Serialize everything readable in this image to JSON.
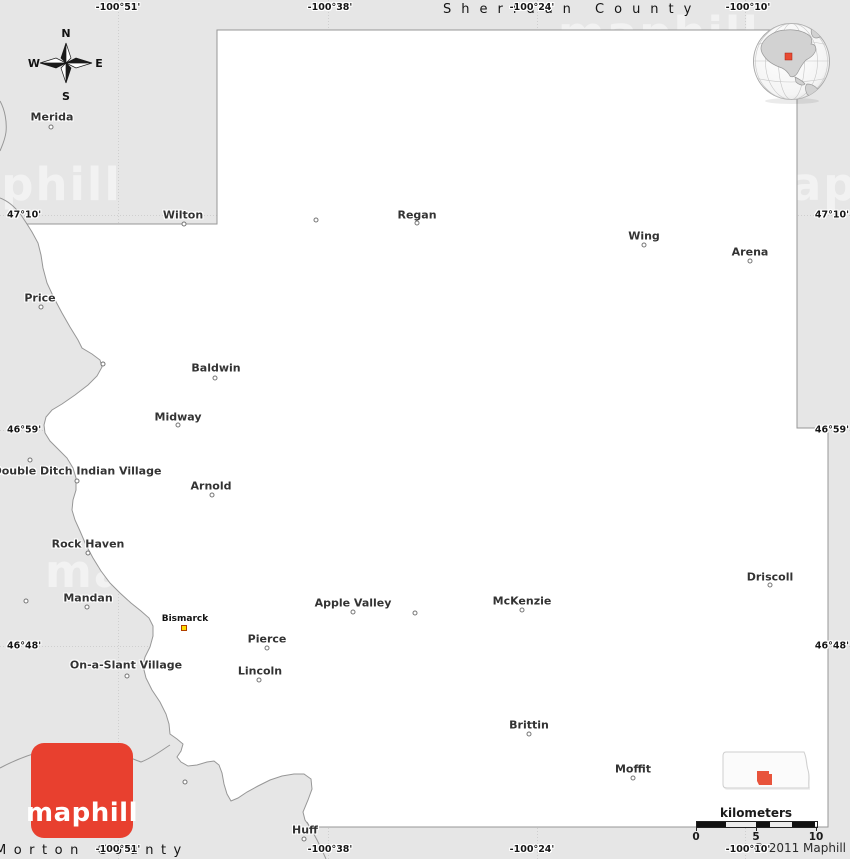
{
  "map": {
    "region_labels": [
      {
        "text": "Sheridan County",
        "position": "top"
      },
      {
        "text": "Morton County",
        "position": "bottom"
      }
    ],
    "towns": [
      {
        "name": "Merida",
        "label": [
          52,
          117
        ],
        "marker": [
          51,
          127
        ],
        "type": "circle"
      },
      {
        "name": "Wilton",
        "label": [
          183,
          215
        ],
        "marker": [
          184,
          224
        ],
        "type": "circle"
      },
      {
        "name": "Regan",
        "label": [
          417,
          215
        ],
        "marker": [
          417,
          223
        ],
        "type": "circle"
      },
      {
        "name": "Wing",
        "label": [
          644,
          236
        ],
        "marker": [
          644,
          245
        ],
        "type": "circle"
      },
      {
        "name": "Arena",
        "label": [
          750,
          252
        ],
        "marker": [
          750,
          261
        ],
        "type": "circle"
      },
      {
        "name": "Price",
        "label": [
          40,
          298
        ],
        "marker": [
          41,
          307
        ],
        "type": "circle"
      },
      {
        "name": "Baldwin",
        "label": [
          216,
          368
        ],
        "marker": [
          215,
          378
        ],
        "type": "circle"
      },
      {
        "name": "Midway",
        "label": [
          178,
          417
        ],
        "marker": [
          178,
          425
        ],
        "type": "circle"
      },
      {
        "name": "Double Ditch Indian Village",
        "label": [
          77,
          471
        ],
        "marker": [
          77,
          481
        ],
        "type": "circle"
      },
      {
        "name": "Arnold",
        "label": [
          211,
          486
        ],
        "marker": [
          212,
          495
        ],
        "type": "circle"
      },
      {
        "name": "Rock Haven",
        "label": [
          88,
          544
        ],
        "marker": [
          88,
          553
        ],
        "type": "circle"
      },
      {
        "name": "Mandan",
        "label": [
          88,
          598
        ],
        "marker": [
          87,
          607
        ],
        "type": "circle"
      },
      {
        "name": "Bismarck",
        "label": [
          185,
          619
        ],
        "marker": [
          184,
          628
        ],
        "type": "square",
        "small": true
      },
      {
        "name": "Apple Valley",
        "label": [
          353,
          603
        ],
        "marker": [
          353,
          612
        ],
        "type": "circle"
      },
      {
        "name": "McKenzie",
        "label": [
          522,
          601
        ],
        "marker": [
          522,
          610
        ],
        "type": "circle"
      },
      {
        "name": "Driscoll",
        "label": [
          770,
          577
        ],
        "marker": [
          770,
          585
        ],
        "type": "circle"
      },
      {
        "name": "Pierce",
        "label": [
          267,
          639
        ],
        "marker": [
          267,
          648
        ],
        "type": "circle"
      },
      {
        "name": "Lincoln",
        "label": [
          260,
          671
        ],
        "marker": [
          259,
          680
        ],
        "type": "circle"
      },
      {
        "name": "On-a-Slant Village",
        "label": [
          126,
          665
        ],
        "marker": [
          127,
          676
        ],
        "type": "circle"
      },
      {
        "name": "Brittin",
        "label": [
          529,
          725
        ],
        "marker": [
          529,
          734
        ],
        "type": "circle"
      },
      {
        "name": "Moffit",
        "label": [
          633,
          769
        ],
        "marker": [
          633,
          778
        ],
        "type": "circle"
      },
      {
        "name": "Huff",
        "label": [
          305,
          830
        ],
        "marker": [
          304,
          839
        ],
        "type": "circle"
      }
    ],
    "unnamed_markers": [
      [
        316,
        220
      ],
      [
        103,
        364
      ],
      [
        30,
        460
      ],
      [
        26,
        601
      ],
      [
        415,
        613
      ],
      [
        185,
        782
      ]
    ],
    "longitude_labels": {
      "values": [
        "-100°51'",
        "-100°38'",
        "-100°24'",
        "-100°10'"
      ],
      "x": [
        118,
        330,
        532,
        748
      ]
    },
    "latitude_labels": {
      "values": [
        "47°10'",
        "46°59'",
        "46°48'"
      ],
      "y": [
        215,
        430,
        646
      ]
    }
  },
  "compass": {
    "n": "N",
    "s": "S",
    "e": "E",
    "w": "W"
  },
  "scale_bar": {
    "unit": "kilometers",
    "ticks": [
      "0",
      "5",
      "10"
    ],
    "tick_x": [
      8,
      68,
      128
    ]
  },
  "copyright": "© 2011 Maphill",
  "logo": {
    "text": "maphill"
  },
  "watermark": {
    "text": "maphill",
    "positions": [
      [
        558,
        12
      ],
      [
        395,
        98
      ],
      [
        -80,
        163
      ],
      [
        742,
        163
      ],
      [
        413,
        357
      ],
      [
        448,
        528
      ],
      [
        45,
        550
      ],
      [
        245,
        722
      ]
    ]
  },
  "colors": {
    "outside_fill": "#e6e6e6",
    "county_fill": "#ffffff",
    "border_line": "#979797",
    "gridline": "#cfcfcf",
    "watermark": "#f2f2f2",
    "logo_red": "#e8402f",
    "locator_red": "#e8543c",
    "globe_marker_red": "#e84b33",
    "city_square_yellow": "#ffdd00"
  }
}
